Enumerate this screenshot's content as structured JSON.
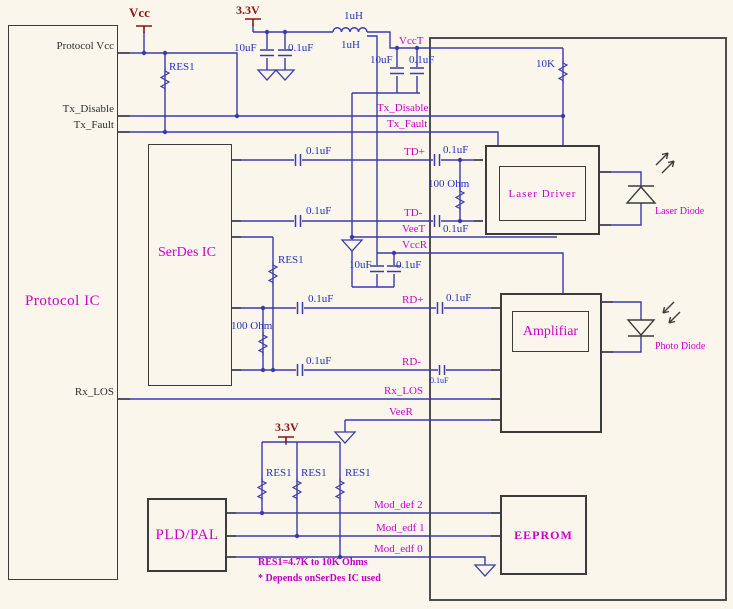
{
  "diagram_title": "Optical transceiver module schematic",
  "colors": {
    "background": "#fbf6ec",
    "wire_blue": "#3a3aad",
    "box_black": "#3c3c3c",
    "label_magenta": "#cc00cc",
    "value_blue": "#2233bb",
    "power_red": "#8b1414"
  },
  "blocks": {
    "protocol_ic": "Protocol IC",
    "serdes_ic": "SerDes  IC",
    "laser_driver": "Laser  Driver",
    "amplifier": "Amplifiar",
    "pld_pal": "PLD/PAL",
    "eeprom": "EEPROM"
  },
  "protocol_pins": {
    "vcc": "Protocol  Vcc",
    "tx_disable": "Tx_Disable",
    "tx_fault": "Tx_Fault",
    "rx_los": "Rx_LOS"
  },
  "net_labels": {
    "vcct": "VccT",
    "tx_disable": "Tx_Disable",
    "tx_fault": "Tx_Fault",
    "td_p": "TD+",
    "td_m": "TD-",
    "veet": "VeeT",
    "vccr": "VccR",
    "rd_p": "RD+",
    "rd_m": "RD-",
    "rx_los": "Rx_LOS",
    "veer": "VeeR",
    "mod_def_2": "Mod_def 2",
    "mod_edf_1": "Mod_edf 1",
    "mod_edf_0": "Mod_edf 0"
  },
  "power_labels": {
    "vcc": "Vcc",
    "v33_top": "3.3V",
    "v33_bottom": "3.3V"
  },
  "component_values": {
    "res1": "RES1",
    "r_10k": "10K",
    "r_100": "100 Ohm",
    "c_10uf": "10uF",
    "c_01uf": "0.1uF",
    "l_1uh": "1uH"
  },
  "diode_labels": {
    "laser": "Laser  Diode",
    "photo": "Photo  Diode"
  },
  "notes": [
    "RES1=4.7K  to  10K Ohms",
    "*  Depends  onSerDes  IC  used"
  ]
}
